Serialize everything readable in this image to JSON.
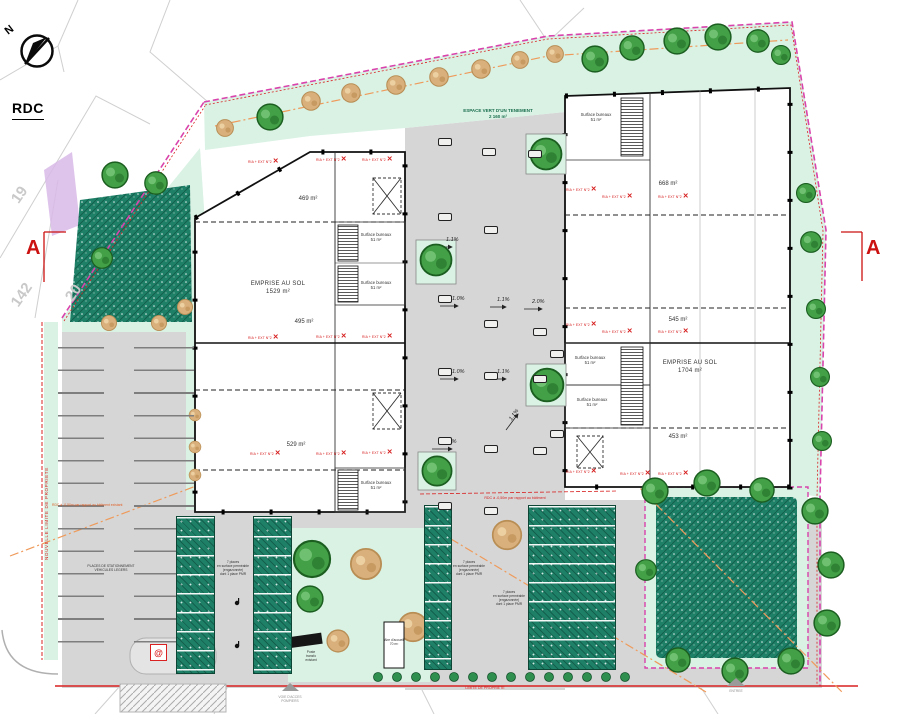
{
  "title": "RDC",
  "compass_north": "N",
  "section_marker": "A",
  "parcels": [
    "19",
    "142",
    "20"
  ],
  "buildings": {
    "left": {
      "unit_areas": [
        "469 m²",
        "495 m²",
        "529 m²"
      ],
      "emprise_label": "EMPRISE AU SOL",
      "emprise_area": "1529 m²",
      "office_label": "Surface bureaux",
      "office_area": "51 m²"
    },
    "right": {
      "unit_areas": [
        "668 m²",
        "545 m²",
        "453 m²"
      ],
      "emprise_label": "EMPRISE AU SOL",
      "emprise_area": "1704 m²",
      "office_label": "Surface bureaux",
      "office_area": "51 m²"
    }
  },
  "landscape": {
    "espace_vert_label": "ESPACE VERT D'UN TENEMENT",
    "espace_vert_area": "2 160 m²"
  },
  "annotations": {
    "fire_tag": "RIA + EXT N°2",
    "fire_cross": "✕",
    "level_note_center": "RDC à -0,50m par rapport au bâtiment",
    "level_note_left": "RDC à -0,50m par rapport au bâtiment existant",
    "property_limit": "NOUVELLE LIMITE DE PROPRIETE",
    "boundary_label": "LIMITE DE PROPRIETE",
    "parking_note": "PLACES DE STATIONNEMENT\nVEHICULES LEGERS",
    "permeable_note": "7 places\nen surface perméable\n(engazonnée)\ndont 1 place PMR",
    "transfo_note": "Poste\ntransfo\nexistant",
    "aire_accueil": "Aire d'accueil\n70 m²",
    "fire_access": "VOIE D'ACCES\nPOMPIERS",
    "access_label": "ENTREE",
    "electric_symbol": "@"
  },
  "slopes": [
    "1.1%",
    "1.0%",
    "1.1%",
    "2.0%",
    "1.0%",
    "1.1%",
    "1.1%",
    "1.0%"
  ],
  "colors": {
    "mint": "#d9f2e4",
    "teal": "#1f8068",
    "tree_green": "#43a047",
    "pavement": "#d6d6d6",
    "boundary_magenta": "#d943ac",
    "red": "#d92121",
    "orange": "#ef9a5a"
  }
}
